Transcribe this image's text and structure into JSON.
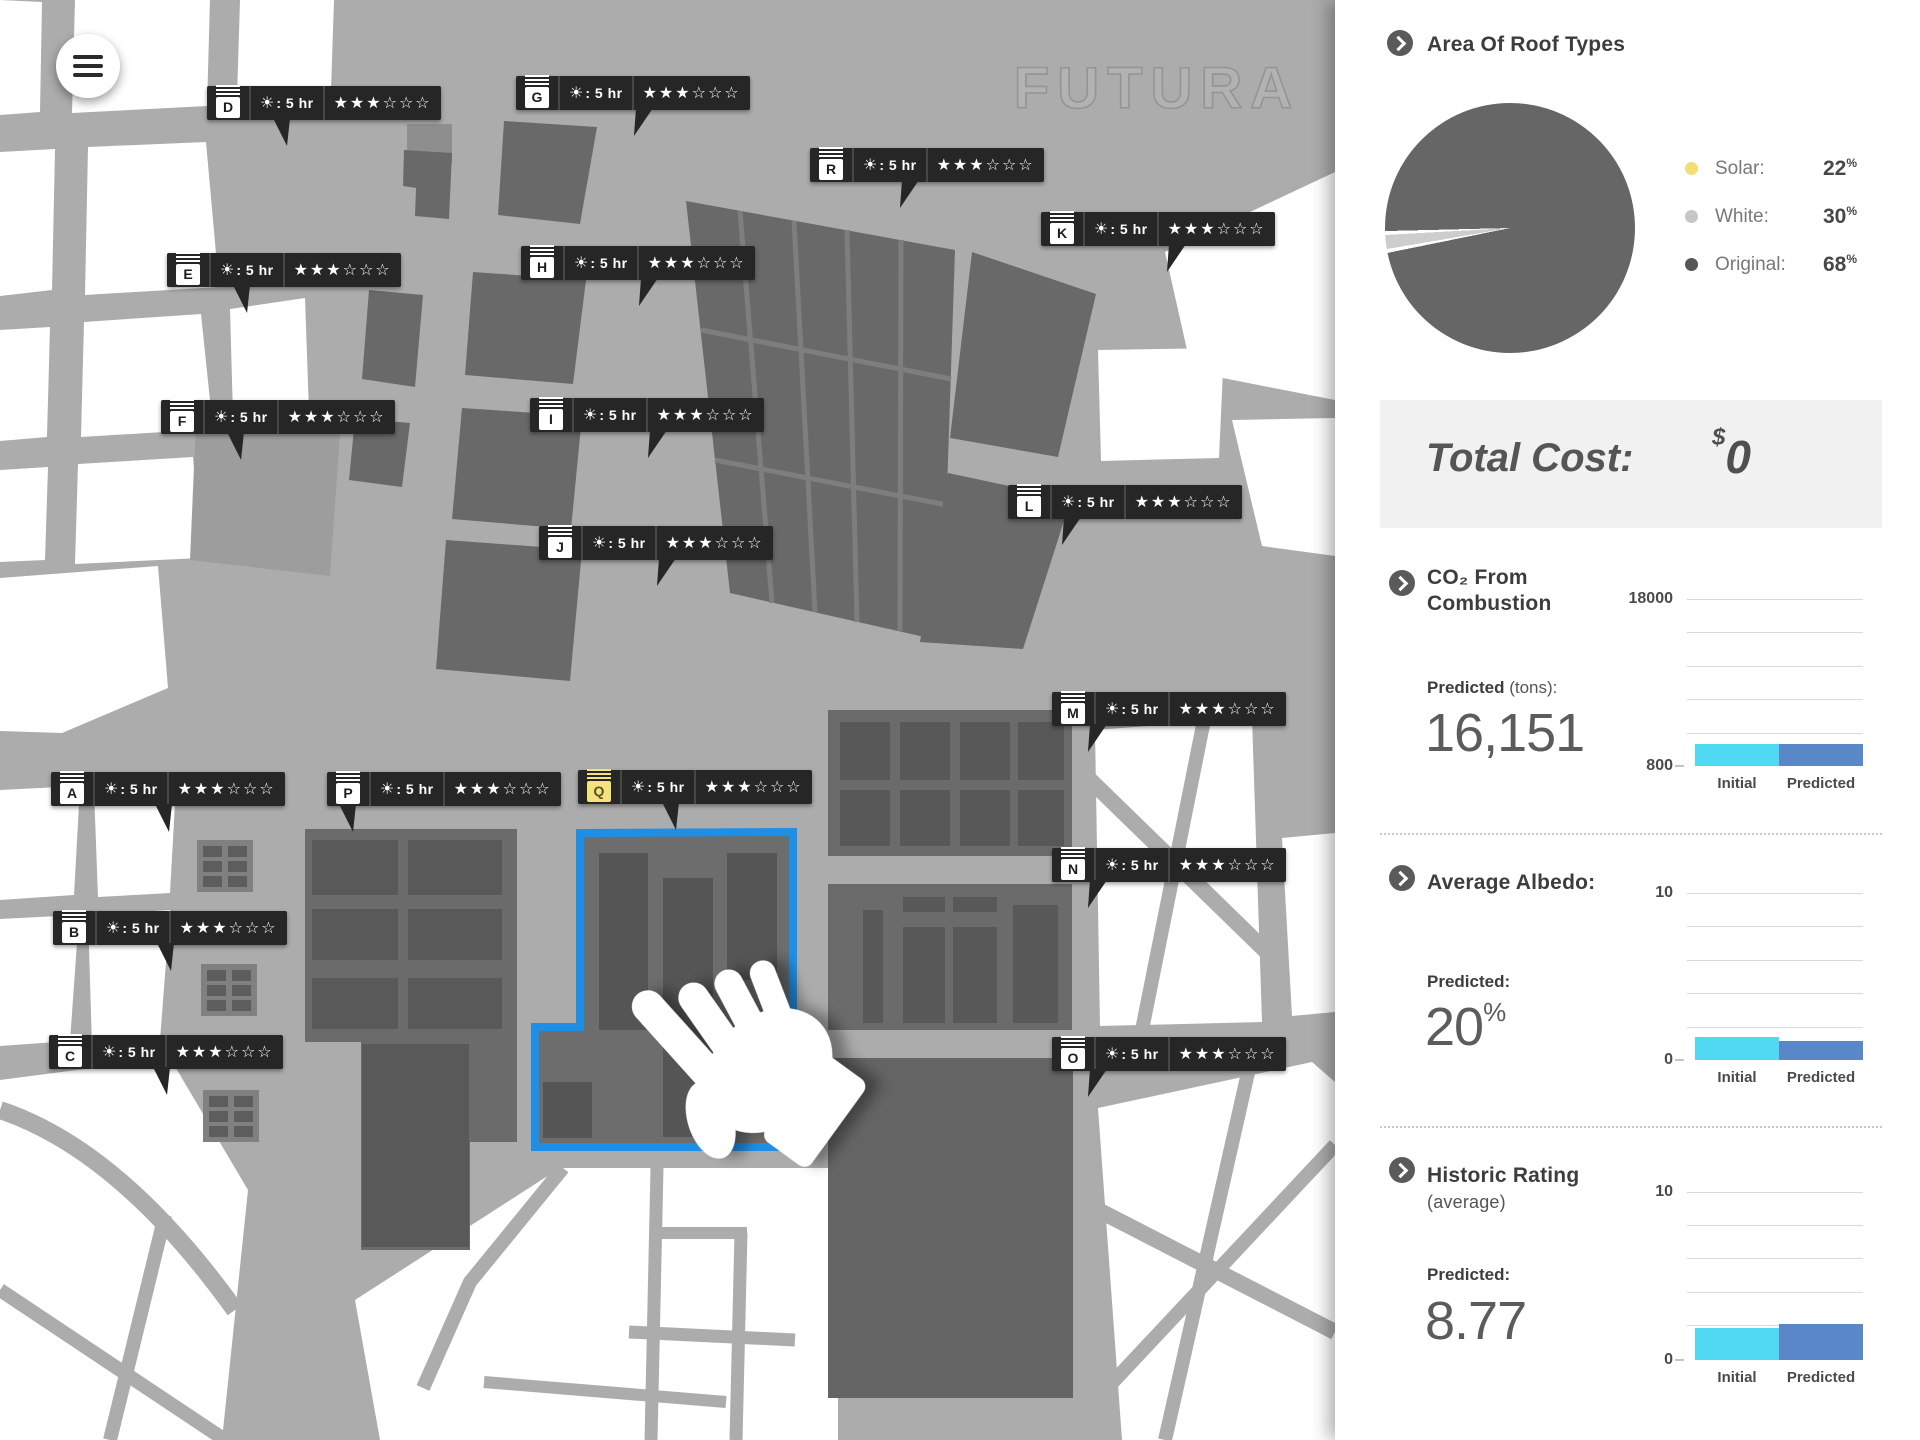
{
  "ui": {
    "menu_icon": "hamburger-icon",
    "section_arrow_icon": "chevron-right-icon"
  },
  "map": {
    "watermark": "FUTURA",
    "selection_color": "#1F8FE6",
    "sun_glyph": "☀",
    "sun_separator": " : ",
    "star_filled_glyph": "★",
    "star_empty_glyph": "☆",
    "buildings": [
      {
        "letter": "A",
        "sun_hours": "5 hr",
        "stars_filled": 3,
        "stars_total": 6,
        "selected": false
      },
      {
        "letter": "B",
        "sun_hours": "5 hr",
        "stars_filled": 3,
        "stars_total": 6,
        "selected": false
      },
      {
        "letter": "C",
        "sun_hours": "5 hr",
        "stars_filled": 3,
        "stars_total": 6,
        "selected": false
      },
      {
        "letter": "D",
        "sun_hours": "5 hr",
        "stars_filled": 3,
        "stars_total": 6,
        "selected": false
      },
      {
        "letter": "E",
        "sun_hours": "5 hr",
        "stars_filled": 3,
        "stars_total": 6,
        "selected": false
      },
      {
        "letter": "F",
        "sun_hours": "5 hr",
        "stars_filled": 3,
        "stars_total": 6,
        "selected": false
      },
      {
        "letter": "G",
        "sun_hours": "5 hr",
        "stars_filled": 3,
        "stars_total": 6,
        "selected": false
      },
      {
        "letter": "H",
        "sun_hours": "5 hr",
        "stars_filled": 3,
        "stars_total": 6,
        "selected": false
      },
      {
        "letter": "I",
        "sun_hours": "5 hr",
        "stars_filled": 3,
        "stars_total": 6,
        "selected": false
      },
      {
        "letter": "J",
        "sun_hours": "5 hr",
        "stars_filled": 3,
        "stars_total": 6,
        "selected": false
      },
      {
        "letter": "K",
        "sun_hours": "5 hr",
        "stars_filled": 3,
        "stars_total": 6,
        "selected": false
      },
      {
        "letter": "L",
        "sun_hours": "5 hr",
        "stars_filled": 3,
        "stars_total": 6,
        "selected": false
      },
      {
        "letter": "M",
        "sun_hours": "5 hr",
        "stars_filled": 3,
        "stars_total": 6,
        "selected": false
      },
      {
        "letter": "N",
        "sun_hours": "5 hr",
        "stars_filled": 3,
        "stars_total": 6,
        "selected": false
      },
      {
        "letter": "O",
        "sun_hours": "5 hr",
        "stars_filled": 3,
        "stars_total": 6,
        "selected": false
      },
      {
        "letter": "P",
        "sun_hours": "5 hr",
        "stars_filled": 3,
        "stars_total": 6,
        "selected": false
      },
      {
        "letter": "Q",
        "sun_hours": "5 hr",
        "stars_filled": 3,
        "stars_total": 6,
        "selected": true
      },
      {
        "letter": "R",
        "sun_hours": "5 hr",
        "stars_filled": 3,
        "stars_total": 6,
        "selected": false
      }
    ]
  },
  "sidebar": {
    "roof_types": {
      "title": "Area Of Roof Types",
      "legend": [
        {
          "label": "Solar:",
          "value": "22",
          "unit": "%",
          "color": "#F2DE73"
        },
        {
          "label": "White:",
          "value": "30",
          "unit": "%",
          "color": "#C6C6C6"
        },
        {
          "label": "Original:",
          "value": "68",
          "unit": "%",
          "color": "#575757"
        }
      ]
    },
    "total_cost": {
      "label": "Total Cost:",
      "currency": "$",
      "value": "0"
    },
    "co2": {
      "title_line1": "CO₂ From",
      "title_line2": "Combustion",
      "predicted_label": "Predicted",
      "predicted_unit": "(tons):",
      "predicted_value": "16,151",
      "axis_top": "18000",
      "axis_bottom": "800",
      "bar_labels": [
        "Initial",
        "Predicted"
      ]
    },
    "albedo": {
      "title": "Average Albedo:",
      "predicted_label": "Predicted:",
      "predicted_value": "20",
      "predicted_unit": "%",
      "axis_top": "10",
      "axis_bottom": "0",
      "bar_labels": [
        "Initial",
        "Predicted"
      ]
    },
    "historic": {
      "title": "Historic Rating",
      "subtitle": "(average)",
      "predicted_label": "Predicted:",
      "predicted_value": "8.77",
      "axis_top": "10",
      "axis_bottom": "0",
      "bar_labels": [
        "Initial",
        "Predicted"
      ]
    },
    "bar_colors": {
      "initial": "#4FD9F2",
      "predicted": "#5A87C8"
    }
  },
  "chart_data": [
    {
      "type": "pie",
      "title": "Area Of Roof Types",
      "labels": [
        "Solar",
        "White",
        "Original"
      ],
      "values": [
        22,
        30,
        68
      ],
      "unit": "%",
      "colors": [
        "#F2DE73",
        "#C6C6C6",
        "#575757"
      ],
      "note": "pie rendered almost entirely dark with one thin light sliver"
    },
    {
      "type": "bar",
      "title": "CO2 From Combustion",
      "categories": [
        "Initial",
        "Predicted"
      ],
      "values": [
        3100,
        3100
      ],
      "ylim": [
        800,
        18000
      ],
      "ylabel": "tons",
      "annotation_predicted": 16151,
      "legend_position": "none",
      "grid": true
    },
    {
      "type": "bar",
      "title": "Average Albedo",
      "categories": [
        "Initial",
        "Predicted"
      ],
      "values": [
        1.4,
        1.2
      ],
      "ylim": [
        0,
        10
      ],
      "annotation_predicted_pct": 20,
      "grid": true
    },
    {
      "type": "bar",
      "title": "Historic Rating (average)",
      "categories": [
        "Initial",
        "Predicted"
      ],
      "values": [
        1.9,
        2.2
      ],
      "ylim": [
        0,
        10
      ],
      "annotation_predicted": 8.77,
      "grid": true
    }
  ]
}
